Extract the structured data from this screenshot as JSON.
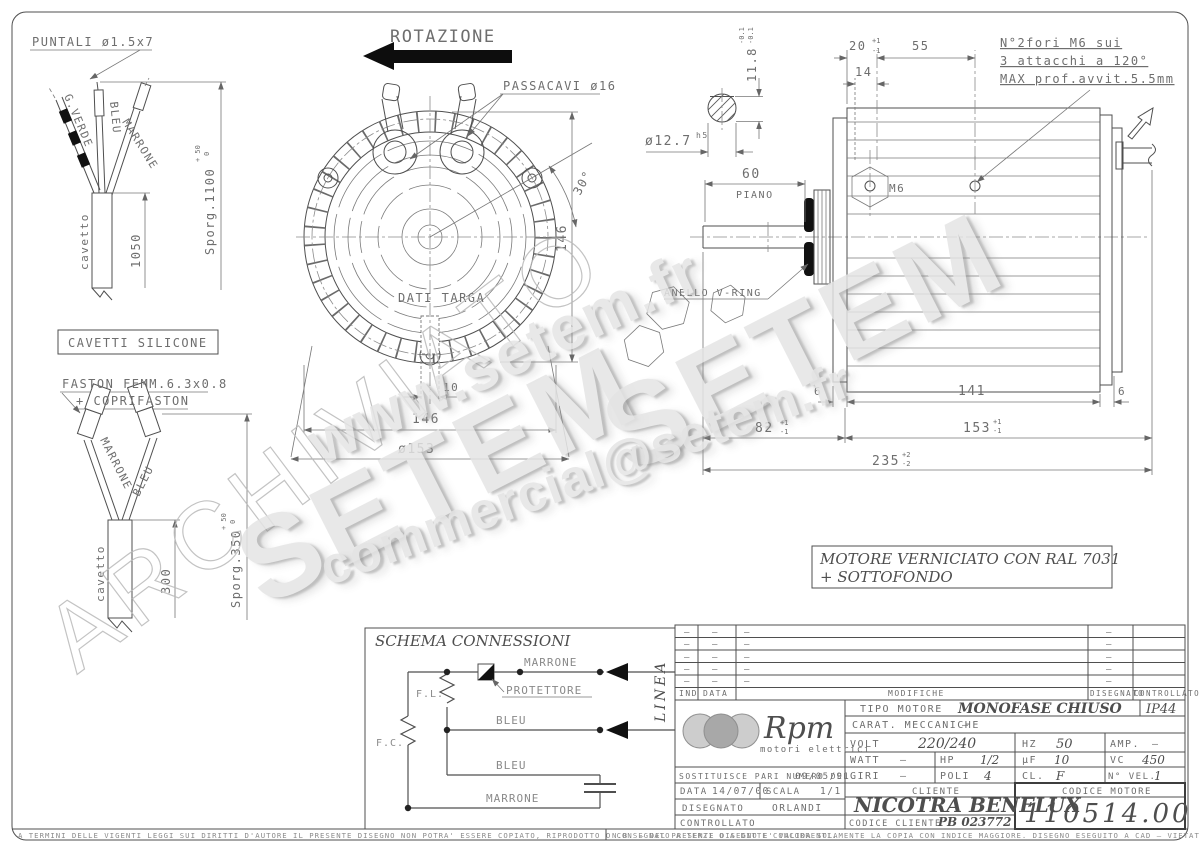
{
  "drawing": {
    "rotazione": "ROTAZIONE",
    "puntali": "PUNTALI ø1.5x7",
    "passacavi": "PASSACAVI ø16",
    "g_verde": "G.VERDE",
    "bleu": "BLEU",
    "marrone": "MARRONE",
    "cavetto_top": "cavetto",
    "cavetto_bottom": "cavetto",
    "dim_1050": "1050",
    "sporg_1100": "Sporg.1100",
    "tol_p50_top": "+ 50",
    "tol_0_top": "0",
    "cavetti_silicone": "CAVETTI SILICONE",
    "faston_1": "FASTON FEMM.6.3x0.8",
    "faston_2": "+ COPRIFASTON",
    "marrone_b": "MARRONE",
    "bleu_b": "BLEU",
    "dim_300": "300",
    "sporg_350": "Sporg.350",
    "tol_p50_bot": "+ 50",
    "tol_0_bot": "0",
    "dati_targa": "DATI TARGA",
    "dim_10": "10",
    "dim_146_h": "146",
    "dim_146_v": "146",
    "dia_153": "ø153",
    "deg_30": "30°",
    "dia_12_7": "ø12.7",
    "h5": "h5",
    "dim_11_8": "11.8",
    "tol_m01_a": "-0.1",
    "tol_m01_b": "-0.1",
    "dim_20": "20",
    "dim_55": "55",
    "dim_14": "14",
    "tol_p1_20": "+1",
    "tol_m1_20": "-1",
    "m6_note_1": "N°2fori M6 sui",
    "m6_note_2": "3 attacchi a 120°",
    "m6_note_3": "MAX prof.avvit.5.5mm",
    "m6": "M6",
    "dim_60": "60",
    "piano": "PIANO",
    "anello_v_ring": "ANELLO V-RING",
    "dim_6_left": "6",
    "dim_141": "141",
    "dim_6_right": "6",
    "dim_82": "82",
    "tol_p1_82": "+1",
    "tol_m1_82": "-1",
    "dim_153": "153",
    "tol_p1_153": "+1",
    "tol_m1_153": "-1",
    "dim_235": "235",
    "tol_p2_235": "+2",
    "tol_m2_235": "-2",
    "paint_1": "MOTORE VERNICIATO CON RAL 7031",
    "paint_2": "+ SOTTOFONDO"
  },
  "schema": {
    "title": "SCHEMA CONNESSIONI",
    "marrone_top": "MARRONE",
    "protettore": "PROTETTORE",
    "f_l": "F.L.",
    "f_c": "F.C.",
    "bleu_mid": "BLEU",
    "bleu_low": "BLEU",
    "marrone_bottom": "MARRONE",
    "linea": "LINEA"
  },
  "watermarks": {
    "url": "www.setem.fr",
    "setem_a": "SETEM",
    "setem_b": "SETEM",
    "email": "commercial@setem.fr",
    "archive": "ARCHIVIATO"
  },
  "titleblock": {
    "headers": {
      "ind": "IND",
      "data": "DATA",
      "modifiche": "MODIFICHE",
      "disegnato": "DISEGNATO",
      "controllato": "CONTROLLATO"
    },
    "dash": "–",
    "logo": {
      "name": "Rpm",
      "sub": "motori elettrici"
    },
    "tipo_motore_label": "TIPO MOTORE",
    "tipo_motore": "MONOFASE CHIUSO",
    "protezione": "IP44",
    "carat_label": "CARAT. MECCANICHE",
    "carat": "–",
    "volt_label": "VOLT",
    "volt": "220/240",
    "hz_label": "HZ",
    "hz": "50",
    "amp_label": "AMP.",
    "amp": "–",
    "watt_label": "WATT",
    "watt": "–",
    "hp_label": "HP",
    "hp": "1/2",
    "uf_label": "μF",
    "uf": "10",
    "vc_label": "VC",
    "vc": "450",
    "giri_label": "GIRI",
    "giri": "–",
    "poli_label": "POLI",
    "poli": "4",
    "cl_label": "CL.",
    "cl": "F",
    "nvel_label": "N° VEL.",
    "nvel": "1",
    "sostituisce_label": "SOSTITUISCE PARI NUMERO DEL",
    "sostituisce_data": "09/05/91",
    "data_label": "DATA",
    "data": "14/07/00",
    "scala_label": "SCALA",
    "scala": "1/1",
    "disegnato_label": "DISEGNATO",
    "disegnato": "ORLANDI",
    "controllato_label": "CONTROLLATO",
    "cliente_label": "CLIENTE",
    "cliente": "NICOTRA BENELUX",
    "codice_cliente_label": "CODICE CLIENTE",
    "codice_cliente": "PB 023772",
    "codice_motore_label": "CODICE MOTORE",
    "codice_motore": "110514.00"
  },
  "footer": {
    "left": "A TERMINI DELLE VIGENTI LEGGI SUI DIRITTI D'AUTORE IL PRESENTE DISEGNO NON POTRA' ESSERE COPIATO, RIPRODOTTO O CONSEGNATO A TERZI O A DITTE CONCORRENTI.",
    "right": "N.B. – DEL PRESENTE DISEGNO E' VALIDA SOLAMENTE LA COPIA CON INDICE MAGGIORE.     DISEGNO ESEGUITO A CAD – VIETATA LA MODIFICA MANUALE"
  }
}
